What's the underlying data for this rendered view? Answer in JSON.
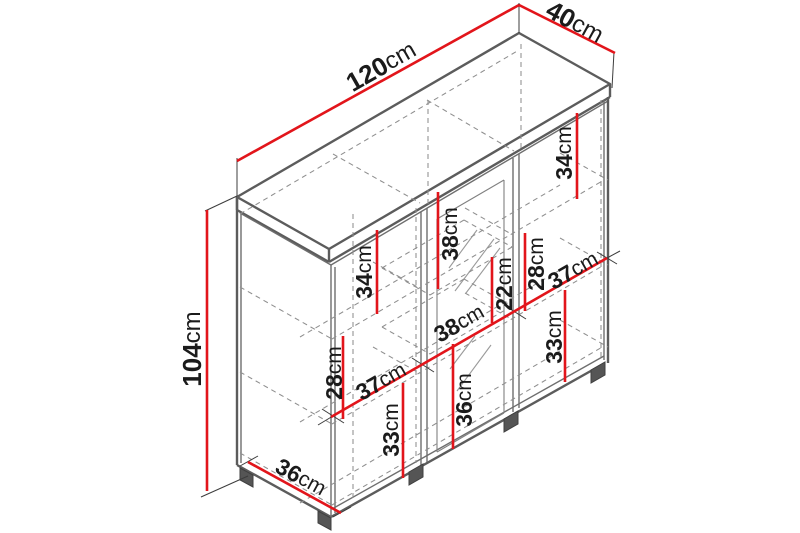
{
  "diagram_title": "Cabinet isometric dimension drawing",
  "colors": {
    "dimension_line": "#e2151b",
    "label_text": "#1b1b1b",
    "outline": "#5c5c5c",
    "background": "#ffffff"
  },
  "dimensions": {
    "width_top": {
      "value": "120",
      "unit": "cm"
    },
    "depth_top": {
      "value": "40",
      "unit": "cm"
    },
    "height_left": {
      "value": "104",
      "unit": "cm"
    },
    "left_gap_top": {
      "value": "34",
      "unit": "cm"
    },
    "left_gap_mid": {
      "value": "28",
      "unit": "cm"
    },
    "left_gap_bottom": {
      "value": "33",
      "unit": "cm"
    },
    "mid_gap_top": {
      "value": "38",
      "unit": "cm"
    },
    "mid_gap_shelf": {
      "value": "22",
      "unit": "cm"
    },
    "mid_gap_bottom": {
      "value": "36",
      "unit": "cm"
    },
    "right_gap_top": {
      "value": "34",
      "unit": "cm"
    },
    "right_gap_mid": {
      "value": "28",
      "unit": "cm"
    },
    "right_gap_bottom": {
      "value": "33",
      "unit": "cm"
    },
    "shelf_width_left": {
      "value": "37",
      "unit": "cm"
    },
    "shelf_width_mid": {
      "value": "38",
      "unit": "cm"
    },
    "shelf_width_right": {
      "value": "37",
      "unit": "cm"
    },
    "bottom_depth": {
      "value": "36",
      "unit": "cm"
    }
  }
}
